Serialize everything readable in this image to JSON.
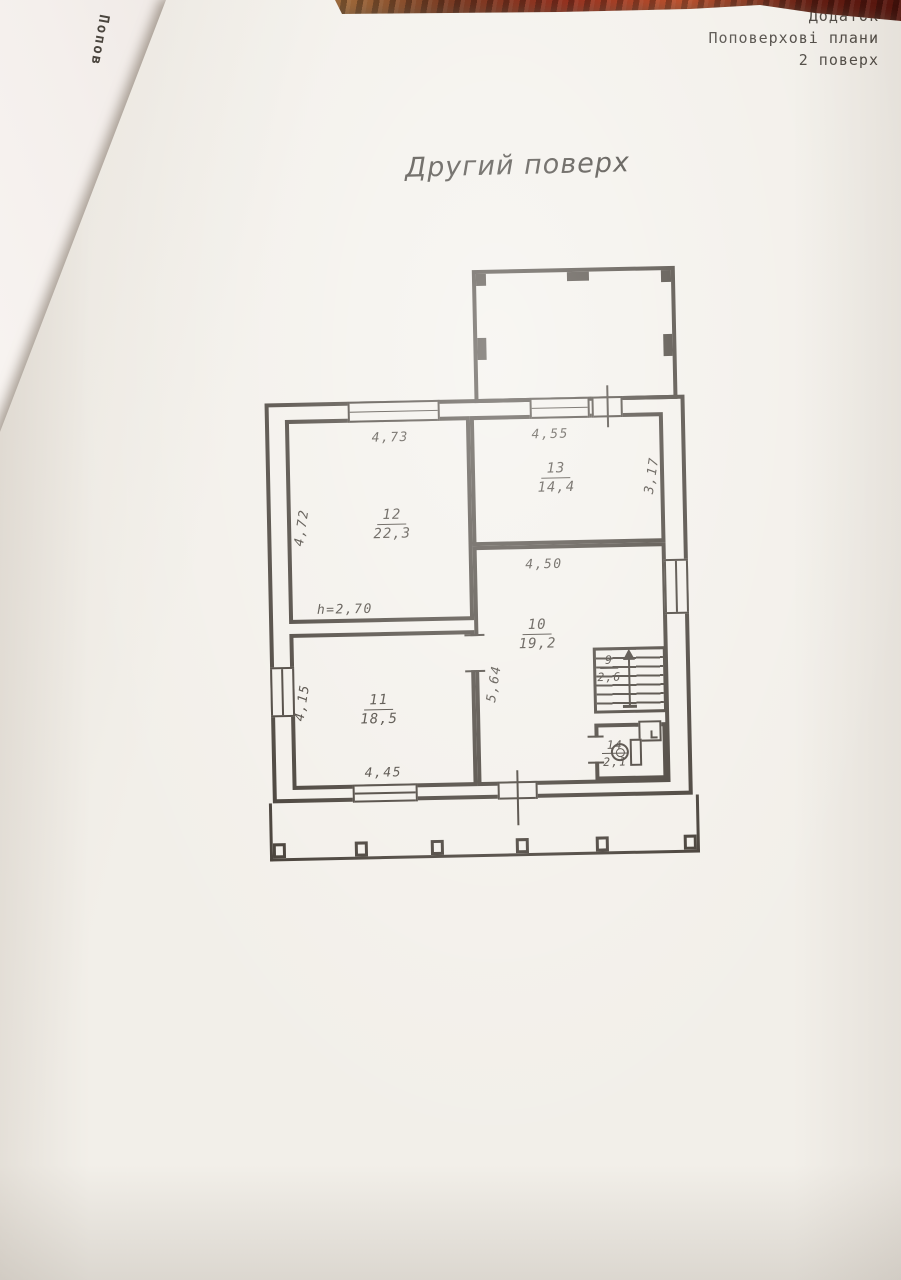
{
  "page": {
    "header": {
      "line1": "Додаток",
      "line2": "Поповерхові плани",
      "line3": "2 поверх"
    },
    "fold_text": "Попов",
    "title": "Другий поверх"
  },
  "plan": {
    "height_note": "h=2,70",
    "rooms": {
      "r9": {
        "number": "9",
        "area": "2,6"
      },
      "r10": {
        "number": "10",
        "area": "19,2"
      },
      "r11": {
        "number": "11",
        "area": "18,5"
      },
      "r12": {
        "number": "12",
        "area": "22,3"
      },
      "r13": {
        "number": "13",
        "area": "14,4"
      },
      "r14": {
        "number": "14",
        "area": "2,1"
      }
    },
    "dims": {
      "top_r12": "4,73",
      "left_r12": "4,72",
      "top_r13": "4,55",
      "right_r13": "3,17",
      "top_r10": "4,50",
      "left_r10": "5,64",
      "left_r11": "4,15",
      "bottom_r11": "4,45"
    }
  },
  "colors": {
    "ink": "#3a332b",
    "paper": "#f2efe9"
  }
}
